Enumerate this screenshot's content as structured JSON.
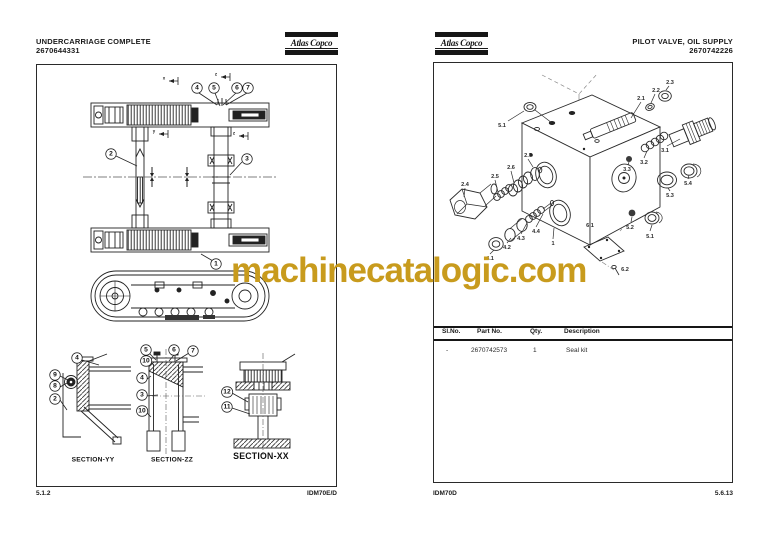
{
  "brand": {
    "name": "Atlas Copco"
  },
  "watermark": {
    "text": "machinecatalogic.com",
    "color": "#C89B1D"
  },
  "left_page": {
    "title": "UNDERCARRIAGE COMPLETE",
    "part_number": "2670644331",
    "footer": {
      "page": "5.1.2",
      "doc": "IDM70E/D"
    },
    "figure": {
      "callouts": [
        {
          "t": "4",
          "x": 160,
          "y": 23
        },
        {
          "t": "5",
          "x": 177,
          "y": 23
        },
        {
          "t": "6",
          "x": 200,
          "y": 23
        },
        {
          "t": "7",
          "x": 211,
          "y": 23
        },
        {
          "t": "2",
          "x": 74,
          "y": 89
        },
        {
          "t": "3",
          "x": 210,
          "y": 94
        },
        {
          "t": "1",
          "x": 179,
          "y": 199
        },
        {
          "t": "4",
          "x": 40,
          "y": 293
        },
        {
          "t": "9",
          "x": 18,
          "y": 310
        },
        {
          "t": "8",
          "x": 18,
          "y": 321
        },
        {
          "t": "2",
          "x": 18,
          "y": 334
        },
        {
          "t": "5",
          "x": 109,
          "y": 285
        },
        {
          "t": "10",
          "x": 109,
          "y": 296
        },
        {
          "t": "6",
          "x": 137,
          "y": 285
        },
        {
          "t": "7",
          "x": 156,
          "y": 286
        },
        {
          "t": "4",
          "x": 105,
          "y": 313
        },
        {
          "t": "3",
          "x": 105,
          "y": 330
        },
        {
          "t": "10",
          "x": 105,
          "y": 346
        },
        {
          "t": "12",
          "x": 190,
          "y": 327
        },
        {
          "t": "11",
          "x": 190,
          "y": 342
        }
      ],
      "markers": [
        {
          "t": "x",
          "x": 127,
          "y": 13
        },
        {
          "t": "z",
          "x": 179,
          "y": 9
        },
        {
          "t": "y",
          "x": 117,
          "y": 66
        },
        {
          "t": "z",
          "x": 197,
          "y": 68
        }
      ],
      "sections": [
        {
          "t": "SECTION-YY",
          "x": 56,
          "y": 391,
          "big": false
        },
        {
          "t": "SECTION-ZZ",
          "x": 135,
          "y": 391,
          "big": false
        },
        {
          "t": "SECTION-XX",
          "x": 224,
          "y": 387,
          "big": true
        }
      ]
    }
  },
  "right_page": {
    "title": "PILOT VALVE, OIL SUPPLY",
    "part_number": "2670742226",
    "footer": {
      "doc": "IDM70D",
      "page": "5.6.13"
    },
    "figure": {
      "labels": [
        {
          "t": "5.1",
          "x": 68,
          "y": 62
        },
        {
          "t": "2.1",
          "x": 207,
          "y": 35
        },
        {
          "t": "2.2",
          "x": 222,
          "y": 27
        },
        {
          "t": "2.3",
          "x": 236,
          "y": 19
        },
        {
          "t": "3.1",
          "x": 231,
          "y": 87
        },
        {
          "t": "3.2",
          "x": 210,
          "y": 99
        },
        {
          "t": "3.3",
          "x": 193,
          "y": 106
        },
        {
          "t": "5.3",
          "x": 236,
          "y": 132
        },
        {
          "t": "5.4",
          "x": 254,
          "y": 120
        },
        {
          "t": "2.7",
          "x": 94,
          "y": 92
        },
        {
          "t": "2.6",
          "x": 77,
          "y": 104
        },
        {
          "t": "2.5",
          "x": 61,
          "y": 113
        },
        {
          "t": "2.4",
          "x": 31,
          "y": 121
        },
        {
          "t": "4.4",
          "x": 102,
          "y": 168
        },
        {
          "t": "4.3",
          "x": 87,
          "y": 175
        },
        {
          "t": "4.2",
          "x": 73,
          "y": 184
        },
        {
          "t": "4.1",
          "x": 56,
          "y": 195
        },
        {
          "t": "1",
          "x": 119,
          "y": 180
        },
        {
          "t": "6.1",
          "x": 156,
          "y": 162
        },
        {
          "t": "5.2",
          "x": 196,
          "y": 164
        },
        {
          "t": "5.1",
          "x": 216,
          "y": 173
        },
        {
          "t": "6.2",
          "x": 191,
          "y": 206
        }
      ]
    },
    "table": {
      "headers": [
        "Sl.No.",
        "Part No.",
        "Qty.",
        "Description"
      ],
      "rows": [
        [
          "-",
          "2670742573",
          "1",
          "Seal kit"
        ]
      ]
    }
  }
}
